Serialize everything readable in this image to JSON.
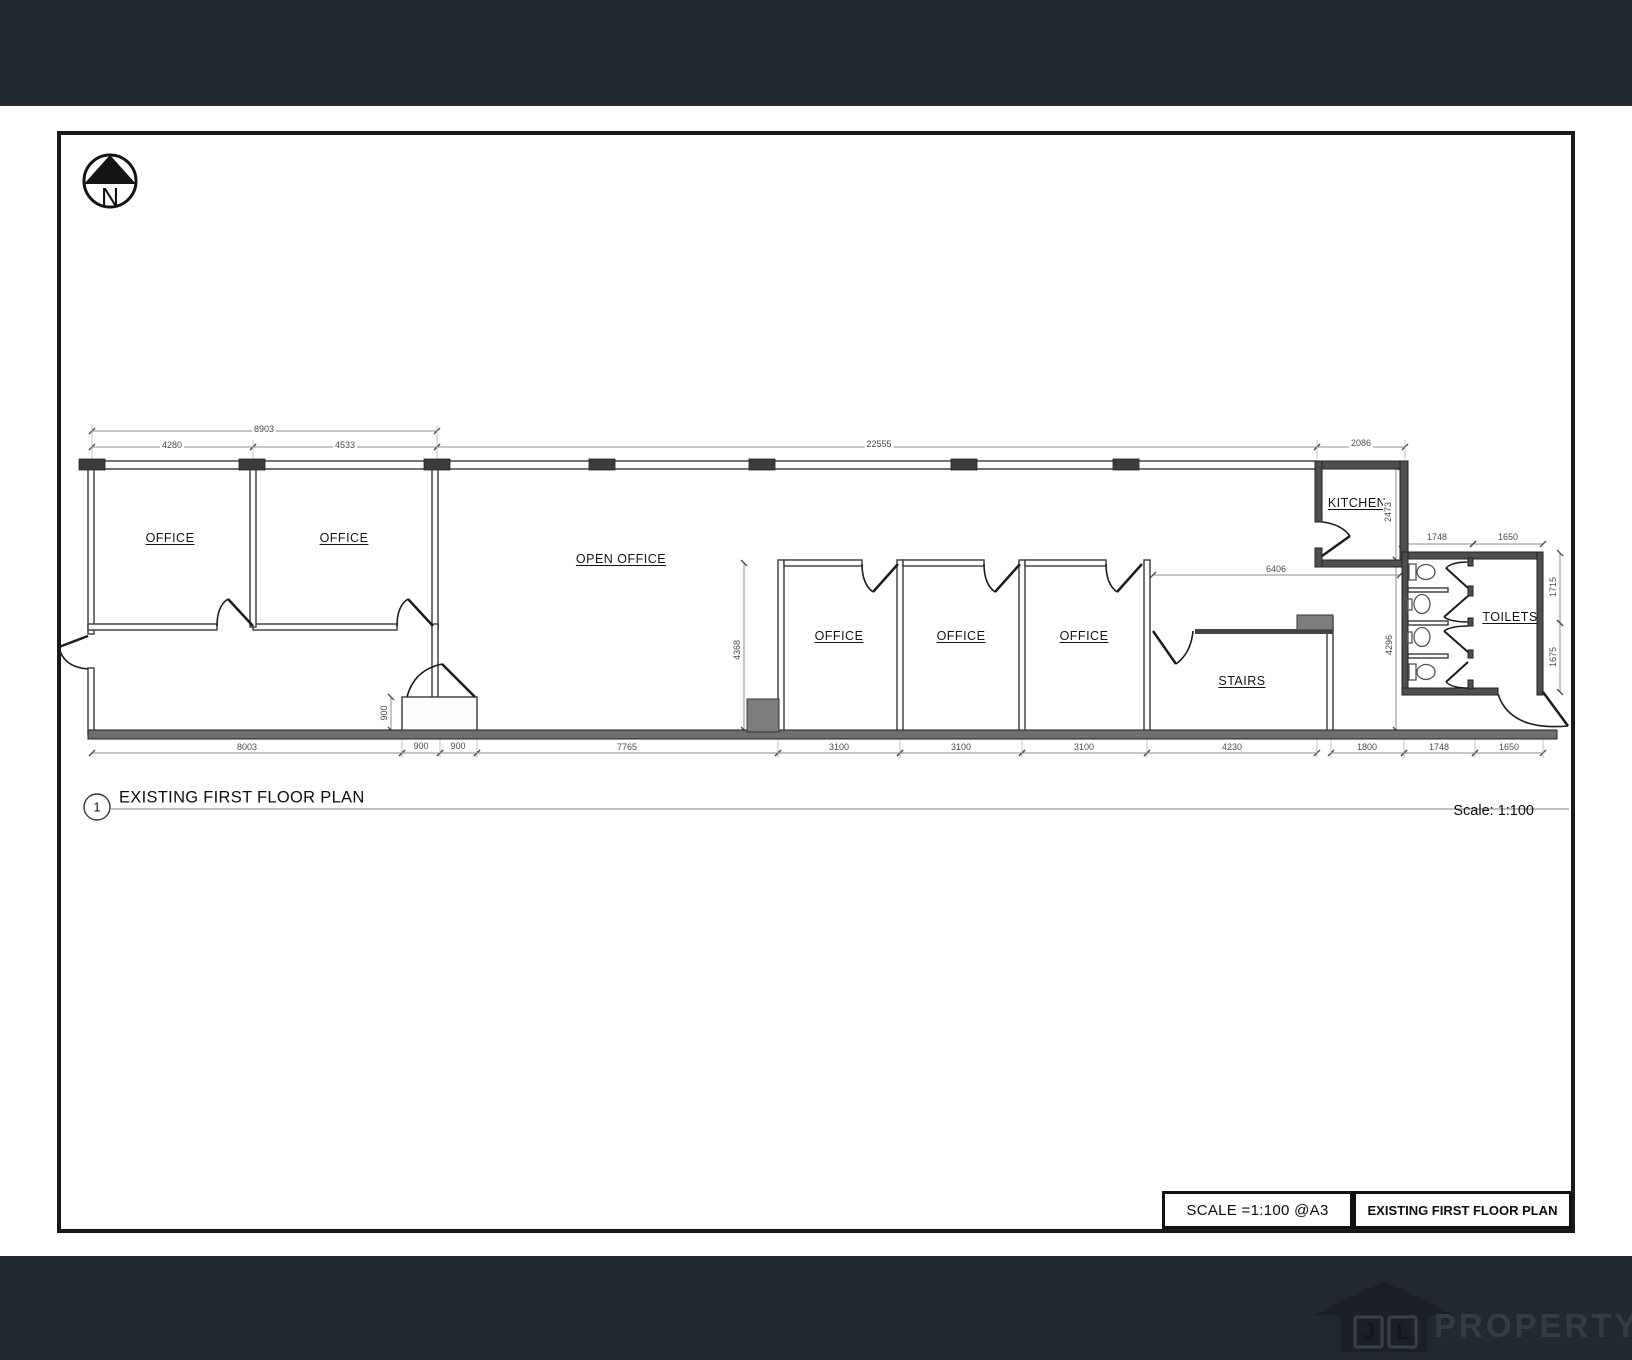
{
  "north_label": "N",
  "plan": {
    "rooms": [
      "OFFICE",
      "OFFICE",
      "OPEN OFFICE",
      "OFFICE",
      "OFFICE",
      "OFFICE",
      "STAIRS",
      "KITCHEN",
      "TOILETS"
    ],
    "dims": [
      "8903",
      "4280",
      "4533",
      "22555",
      "2086",
      "1748",
      "1650",
      "1715",
      "1675",
      "2473",
      "4296",
      "4368",
      "6406",
      "900",
      "8003",
      "900",
      "900",
      "7765",
      "3100",
      "3100",
      "3100",
      "4230",
      "1800",
      "1748",
      "1650"
    ]
  },
  "title": {
    "number": "1",
    "text": "EXISTING FIRST FLOOR PLAN",
    "scale": "Scale: 1:100"
  },
  "title_block": {
    "scale": "SCALE =1:100  @A3",
    "name": "EXISTING FIRST FLOOR PLAN"
  },
  "footer": {
    "logo_initial_1": "J",
    "logo_initial_2": "L",
    "logo_text": "PROPERTY"
  },
  "colors": {
    "band": "#222831",
    "wall_dark": "#4e4e4e",
    "south_wall": "#6f6f6f",
    "duct_gray": "#7d7d7d",
    "line": "#2a2a2a"
  }
}
